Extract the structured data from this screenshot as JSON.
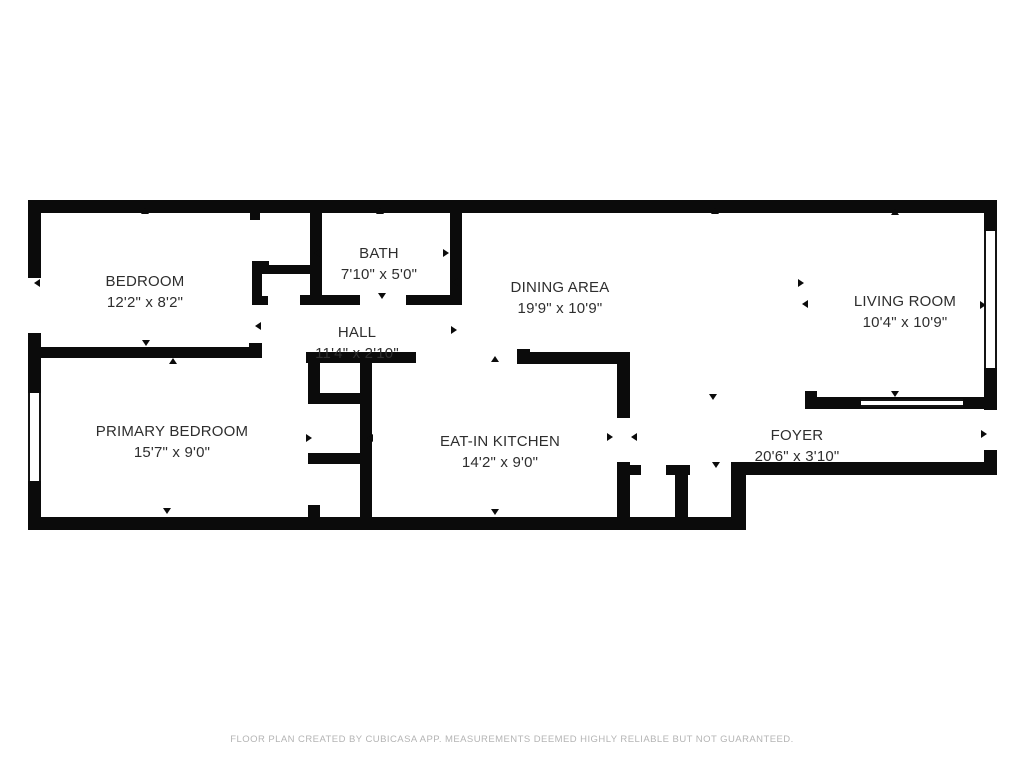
{
  "page": {
    "background": "#ffffff",
    "wall_color": "#0b0b0b",
    "text_color": "#2e2e2e",
    "footer_color": "#b4b4b4"
  },
  "rooms": [
    {
      "id": "bedroom",
      "name": "BEDROOM",
      "dims": "12'2\" x 8'2\"",
      "cx": 145,
      "top": 271
    },
    {
      "id": "bath",
      "name": "BATH",
      "dims": "7'10\" x 5'0\"",
      "cx": 379,
      "top": 243
    },
    {
      "id": "hall",
      "name": "HALL",
      "dims": "11'4\" x 2'10\"",
      "cx": 357,
      "top": 322
    },
    {
      "id": "dining-area",
      "name": "DINING AREA",
      "dims": "19'9\" x 10'9\"",
      "cx": 560,
      "top": 277
    },
    {
      "id": "living-room",
      "name": "LIVING ROOM",
      "dims": "10'4\" x 10'9\"",
      "cx": 905,
      "top": 291
    },
    {
      "id": "primary-bedroom",
      "name": "PRIMARY BEDROOM",
      "dims": "15'7\" x 9'0\"",
      "cx": 172,
      "top": 421
    },
    {
      "id": "eat-in-kitchen",
      "name": "EAT-IN KITCHEN",
      "dims": "14'2\" x 9'0\"",
      "cx": 500,
      "top": 431
    },
    {
      "id": "foyer",
      "name": "FOYER",
      "dims": "20'6\" x 3'10\"",
      "cx": 797,
      "top": 425
    }
  ],
  "footer": {
    "text": "FLOOR PLAN CREATED BY CUBICASA APP. MEASUREMENTS DEEMED HIGHLY RELIABLE BUT NOT GUARANTEED."
  },
  "geometry": {
    "walls": [
      {
        "name": "top-exterior",
        "x": 28,
        "y": 200,
        "w": 969,
        "h": 13
      },
      {
        "name": "left-exterior-upper",
        "x": 28,
        "y": 200,
        "w": 13,
        "h": 78
      },
      {
        "name": "left-exterior-mid",
        "x": 28,
        "y": 333,
        "w": 13,
        "h": 62
      },
      {
        "name": "left-exterior-lower",
        "x": 28,
        "y": 481,
        "w": 13,
        "h": 49
      },
      {
        "name": "bottom-exterior",
        "x": 28,
        "y": 517,
        "w": 718,
        "h": 13
      },
      {
        "name": "foyer-bottom",
        "x": 731,
        "y": 462,
        "w": 266,
        "h": 13
      },
      {
        "name": "foyer-bottom-right-cap",
        "x": 984,
        "y": 450,
        "w": 13,
        "h": 25
      },
      {
        "name": "right-exterior-upper",
        "x": 984,
        "y": 200,
        "w": 13,
        "h": 31
      },
      {
        "name": "right-exterior-lower",
        "x": 984,
        "y": 368,
        "w": 13,
        "h": 42
      },
      {
        "name": "right-window-inner",
        "x": 988,
        "y": 233,
        "w": 2,
        "h": 133
      },
      {
        "name": "living-room-bottom",
        "x": 805,
        "y": 397,
        "w": 192,
        "h": 12
      },
      {
        "name": "living-room-bottom-cap",
        "x": 805,
        "y": 391,
        "w": 12,
        "h": 18
      },
      {
        "name": "bath-left",
        "x": 310,
        "y": 200,
        "w": 12,
        "h": 105
      },
      {
        "name": "bath-right",
        "x": 450,
        "y": 200,
        "w": 12,
        "h": 105
      },
      {
        "name": "bath-bottom-left",
        "x": 300,
        "y": 295,
        "w": 60,
        "h": 10
      },
      {
        "name": "bath-bottom-right",
        "x": 406,
        "y": 295,
        "w": 56,
        "h": 10
      },
      {
        "name": "bedroom-closet-top",
        "x": 252,
        "y": 265,
        "w": 58,
        "h": 9
      },
      {
        "name": "bedroom-closet-side",
        "x": 252,
        "y": 261,
        "w": 10,
        "h": 44
      },
      {
        "name": "bedroom-closet-cap-top",
        "x": 252,
        "y": 261,
        "w": 17,
        "h": 9
      },
      {
        "name": "bedroom-closet-cap-bottom",
        "x": 252,
        "y": 296,
        "w": 16,
        "h": 9
      },
      {
        "name": "top-wall-stub",
        "x": 250,
        "y": 213,
        "w": 10,
        "h": 7
      },
      {
        "name": "bedroom-divider",
        "x": 28,
        "y": 347,
        "w": 224,
        "h": 11
      },
      {
        "name": "bedroom-divider-cap",
        "x": 249,
        "y": 343,
        "w": 13,
        "h": 15
      },
      {
        "name": "hall-bottom",
        "x": 306,
        "y": 352,
        "w": 110,
        "h": 11
      },
      {
        "name": "closet-column-left-upper",
        "x": 308,
        "y": 352,
        "w": 12,
        "h": 52
      },
      {
        "name": "closet-column-left-lower",
        "x": 308,
        "y": 505,
        "w": 12,
        "h": 13
      },
      {
        "name": "closet-column-right",
        "x": 360,
        "y": 352,
        "w": 12,
        "h": 166
      },
      {
        "name": "closet-column-divider-a",
        "x": 308,
        "y": 393,
        "w": 64,
        "h": 11
      },
      {
        "name": "closet-column-divider-b",
        "x": 308,
        "y": 453,
        "w": 64,
        "h": 11
      },
      {
        "name": "kitchen-top",
        "x": 517,
        "y": 352,
        "w": 113,
        "h": 12
      },
      {
        "name": "kitchen-top-left-cap",
        "x": 517,
        "y": 349,
        "w": 13,
        "h": 15
      },
      {
        "name": "kitchen-right-upper",
        "x": 617,
        "y": 352,
        "w": 13,
        "h": 66
      },
      {
        "name": "kitchen-right-lower",
        "x": 617,
        "y": 462,
        "w": 13,
        "h": 68
      },
      {
        "name": "foyer-closet-stub-left",
        "x": 617,
        "y": 465,
        "w": 24,
        "h": 10
      },
      {
        "name": "foyer-closet-stub-mid",
        "x": 666,
        "y": 465,
        "w": 24,
        "h": 10
      },
      {
        "name": "foyer-closet-divider",
        "x": 675,
        "y": 465,
        "w": 13,
        "h": 65
      },
      {
        "name": "foyer-closet-right",
        "x": 731,
        "y": 462,
        "w": 15,
        "h": 68
      },
      {
        "name": "left-window-mullion-top",
        "x": 28,
        "y": 430,
        "w": 13,
        "h": 3
      },
      {
        "name": "left-window-mullion-bot",
        "x": 28,
        "y": 438,
        "w": 13,
        "h": 3
      }
    ],
    "windows": [
      {
        "name": "left-window",
        "x": 28,
        "y": 393,
        "w": 13,
        "h": 88,
        "orient": "v"
      },
      {
        "name": "right-window",
        "x": 984,
        "y": 231,
        "w": 13,
        "h": 137,
        "orient": "v"
      },
      {
        "name": "living-room-window",
        "x": 861,
        "y": 399,
        "w": 102,
        "h": 8,
        "orient": "h"
      }
    ],
    "markers": [
      {
        "x": 145,
        "y": 212,
        "d": "up"
      },
      {
        "x": 380,
        "y": 212,
        "d": "up"
      },
      {
        "x": 715,
        "y": 212,
        "d": "up"
      },
      {
        "x": 895,
        "y": 213,
        "d": "up"
      },
      {
        "x": 38,
        "y": 283,
        "d": "left"
      },
      {
        "x": 318,
        "y": 253,
        "d": "left"
      },
      {
        "x": 447,
        "y": 253,
        "d": "right"
      },
      {
        "x": 456,
        "y": 282,
        "d": "left"
      },
      {
        "x": 382,
        "y": 297,
        "d": "down"
      },
      {
        "x": 259,
        "y": 326,
        "d": "left"
      },
      {
        "x": 455,
        "y": 330,
        "d": "right"
      },
      {
        "x": 146,
        "y": 344,
        "d": "down"
      },
      {
        "x": 173,
        "y": 362,
        "d": "up"
      },
      {
        "x": 495,
        "y": 360,
        "d": "up"
      },
      {
        "x": 310,
        "y": 438,
        "d": "right"
      },
      {
        "x": 371,
        "y": 438,
        "d": "left"
      },
      {
        "x": 611,
        "y": 437,
        "d": "right"
      },
      {
        "x": 635,
        "y": 437,
        "d": "left"
      },
      {
        "x": 802,
        "y": 283,
        "d": "right"
      },
      {
        "x": 806,
        "y": 304,
        "d": "left"
      },
      {
        "x": 984,
        "y": 305,
        "d": "right"
      },
      {
        "x": 895,
        "y": 395,
        "d": "down"
      },
      {
        "x": 713,
        "y": 398,
        "d": "down"
      },
      {
        "x": 985,
        "y": 434,
        "d": "right"
      },
      {
        "x": 716,
        "y": 466,
        "d": "down"
      },
      {
        "x": 167,
        "y": 512,
        "d": "down"
      },
      {
        "x": 495,
        "y": 513,
        "d": "down"
      }
    ]
  }
}
